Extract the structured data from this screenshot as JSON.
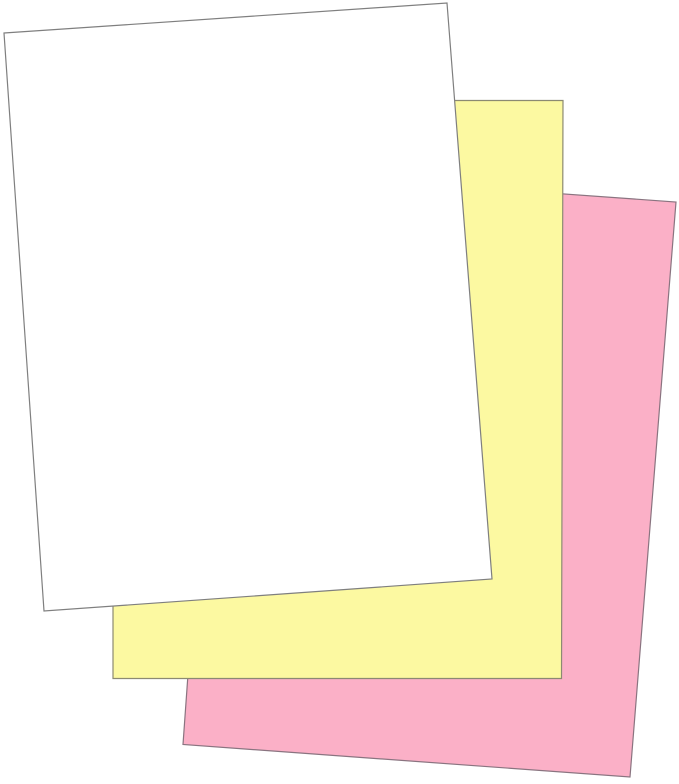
{
  "image": {
    "description": "Three overlapping fanned paper sheets: white on top, canary yellow in middle, pink at back",
    "background_color": "#FFFFFF",
    "outline_color": "#7F7F7F"
  },
  "sheets": [
    {
      "name": "pink-sheet-back",
      "color": "#FBB0C7",
      "outline": "#8A7480"
    },
    {
      "name": "yellow-sheet-middle",
      "color": "#FCF9A1",
      "outline": "#8C8A72"
    },
    {
      "name": "white-sheet-front",
      "color": "#FFFFFF",
      "outline": "#7F7F7F"
    }
  ]
}
